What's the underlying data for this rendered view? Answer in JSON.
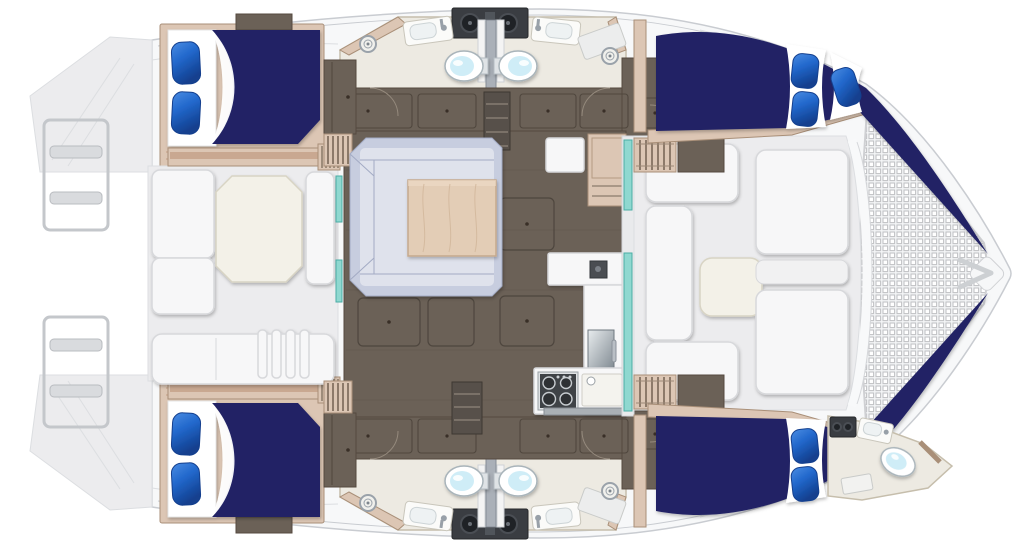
{
  "meta": {
    "title": "Catamaran yacht deck floor plan (top-down)",
    "view": "overhead interior layout",
    "orientation": "bow to the right, stern to the left"
  },
  "palette": {
    "hull_fill": "#f7f8f9",
    "hull_line": "#c9ccd1",
    "deck_fill": "#ececee",
    "deck_line": "#dcdee1",
    "white_furn": "#f7f7f8",
    "furn_line": "#d7d8db",
    "cream": "#f3f1e8",
    "cream_line": "#d8d4c4",
    "tan": "#dcc6b4",
    "tan_dark": "#c39e85",
    "tan_line": "#a98f78",
    "floor_brown": "#6b6157",
    "floor_line": "#55493f",
    "step_dark": "#57504a",
    "bed_navy": "#202465",
    "pillow_hi": "#4a8ce2",
    "pillow_blue": "#2268cc",
    "pillow_dark": "#123f8e",
    "sofa_base": "#c7cddf",
    "sofa_cushion": "#dfe2ec",
    "sofa_line": "#a3abc4",
    "table_wood": "#e3cdb6",
    "wood_line": "#c5a98d",
    "bath_floor": "#edeae2",
    "bath_line": "#c6beac",
    "teal": "#8fd8d0",
    "teal_line": "#4aada5",
    "dark_equip": "#3a3d42",
    "steel": "#9aa2aa",
    "toilet_blue": "#cfedf7",
    "mesh_line": "#c2c3c6"
  },
  "vessel": {
    "type": "sailing catamaran floor plan",
    "cabins": 4,
    "double_berths": 5,
    "toilets": 5,
    "shower_drains": 4,
    "pillows": 9,
    "areas": [
      {
        "id": "bow-trampoline",
        "label": "Bow trampoline net"
      },
      {
        "id": "forward-cockpit",
        "label": "Forward cockpit lounge"
      },
      {
        "id": "salon",
        "label": "Salon with U-shaped sofa and table"
      },
      {
        "id": "galley",
        "label": "Galley with stove, sink and oven"
      },
      {
        "id": "aft-cockpit",
        "label": "Aft cockpit with dining table and lounges"
      },
      {
        "id": "port-forward-cabin",
        "label": "Port forward cabin"
      },
      {
        "id": "starboard-forward-cabin",
        "label": "Starboard forward cabin"
      },
      {
        "id": "port-aft-cabin",
        "label": "Port aft cabin"
      },
      {
        "id": "starboard-aft-cabin",
        "label": "Starboard aft cabin"
      },
      {
        "id": "port-heads",
        "label": "Port hull heads (two bathrooms)"
      },
      {
        "id": "starboard-heads",
        "label": "Starboard hull heads (two bathrooms)"
      },
      {
        "id": "starboard-bow-head",
        "label": "Starboard bow en-suite head"
      },
      {
        "id": "port-transom",
        "label": "Port transom with boarding ladder"
      },
      {
        "id": "starboard-transom",
        "label": "Starboard transom with boarding ladder"
      },
      {
        "id": "stern-davits",
        "label": "Stern dinghy davit lines"
      }
    ]
  }
}
